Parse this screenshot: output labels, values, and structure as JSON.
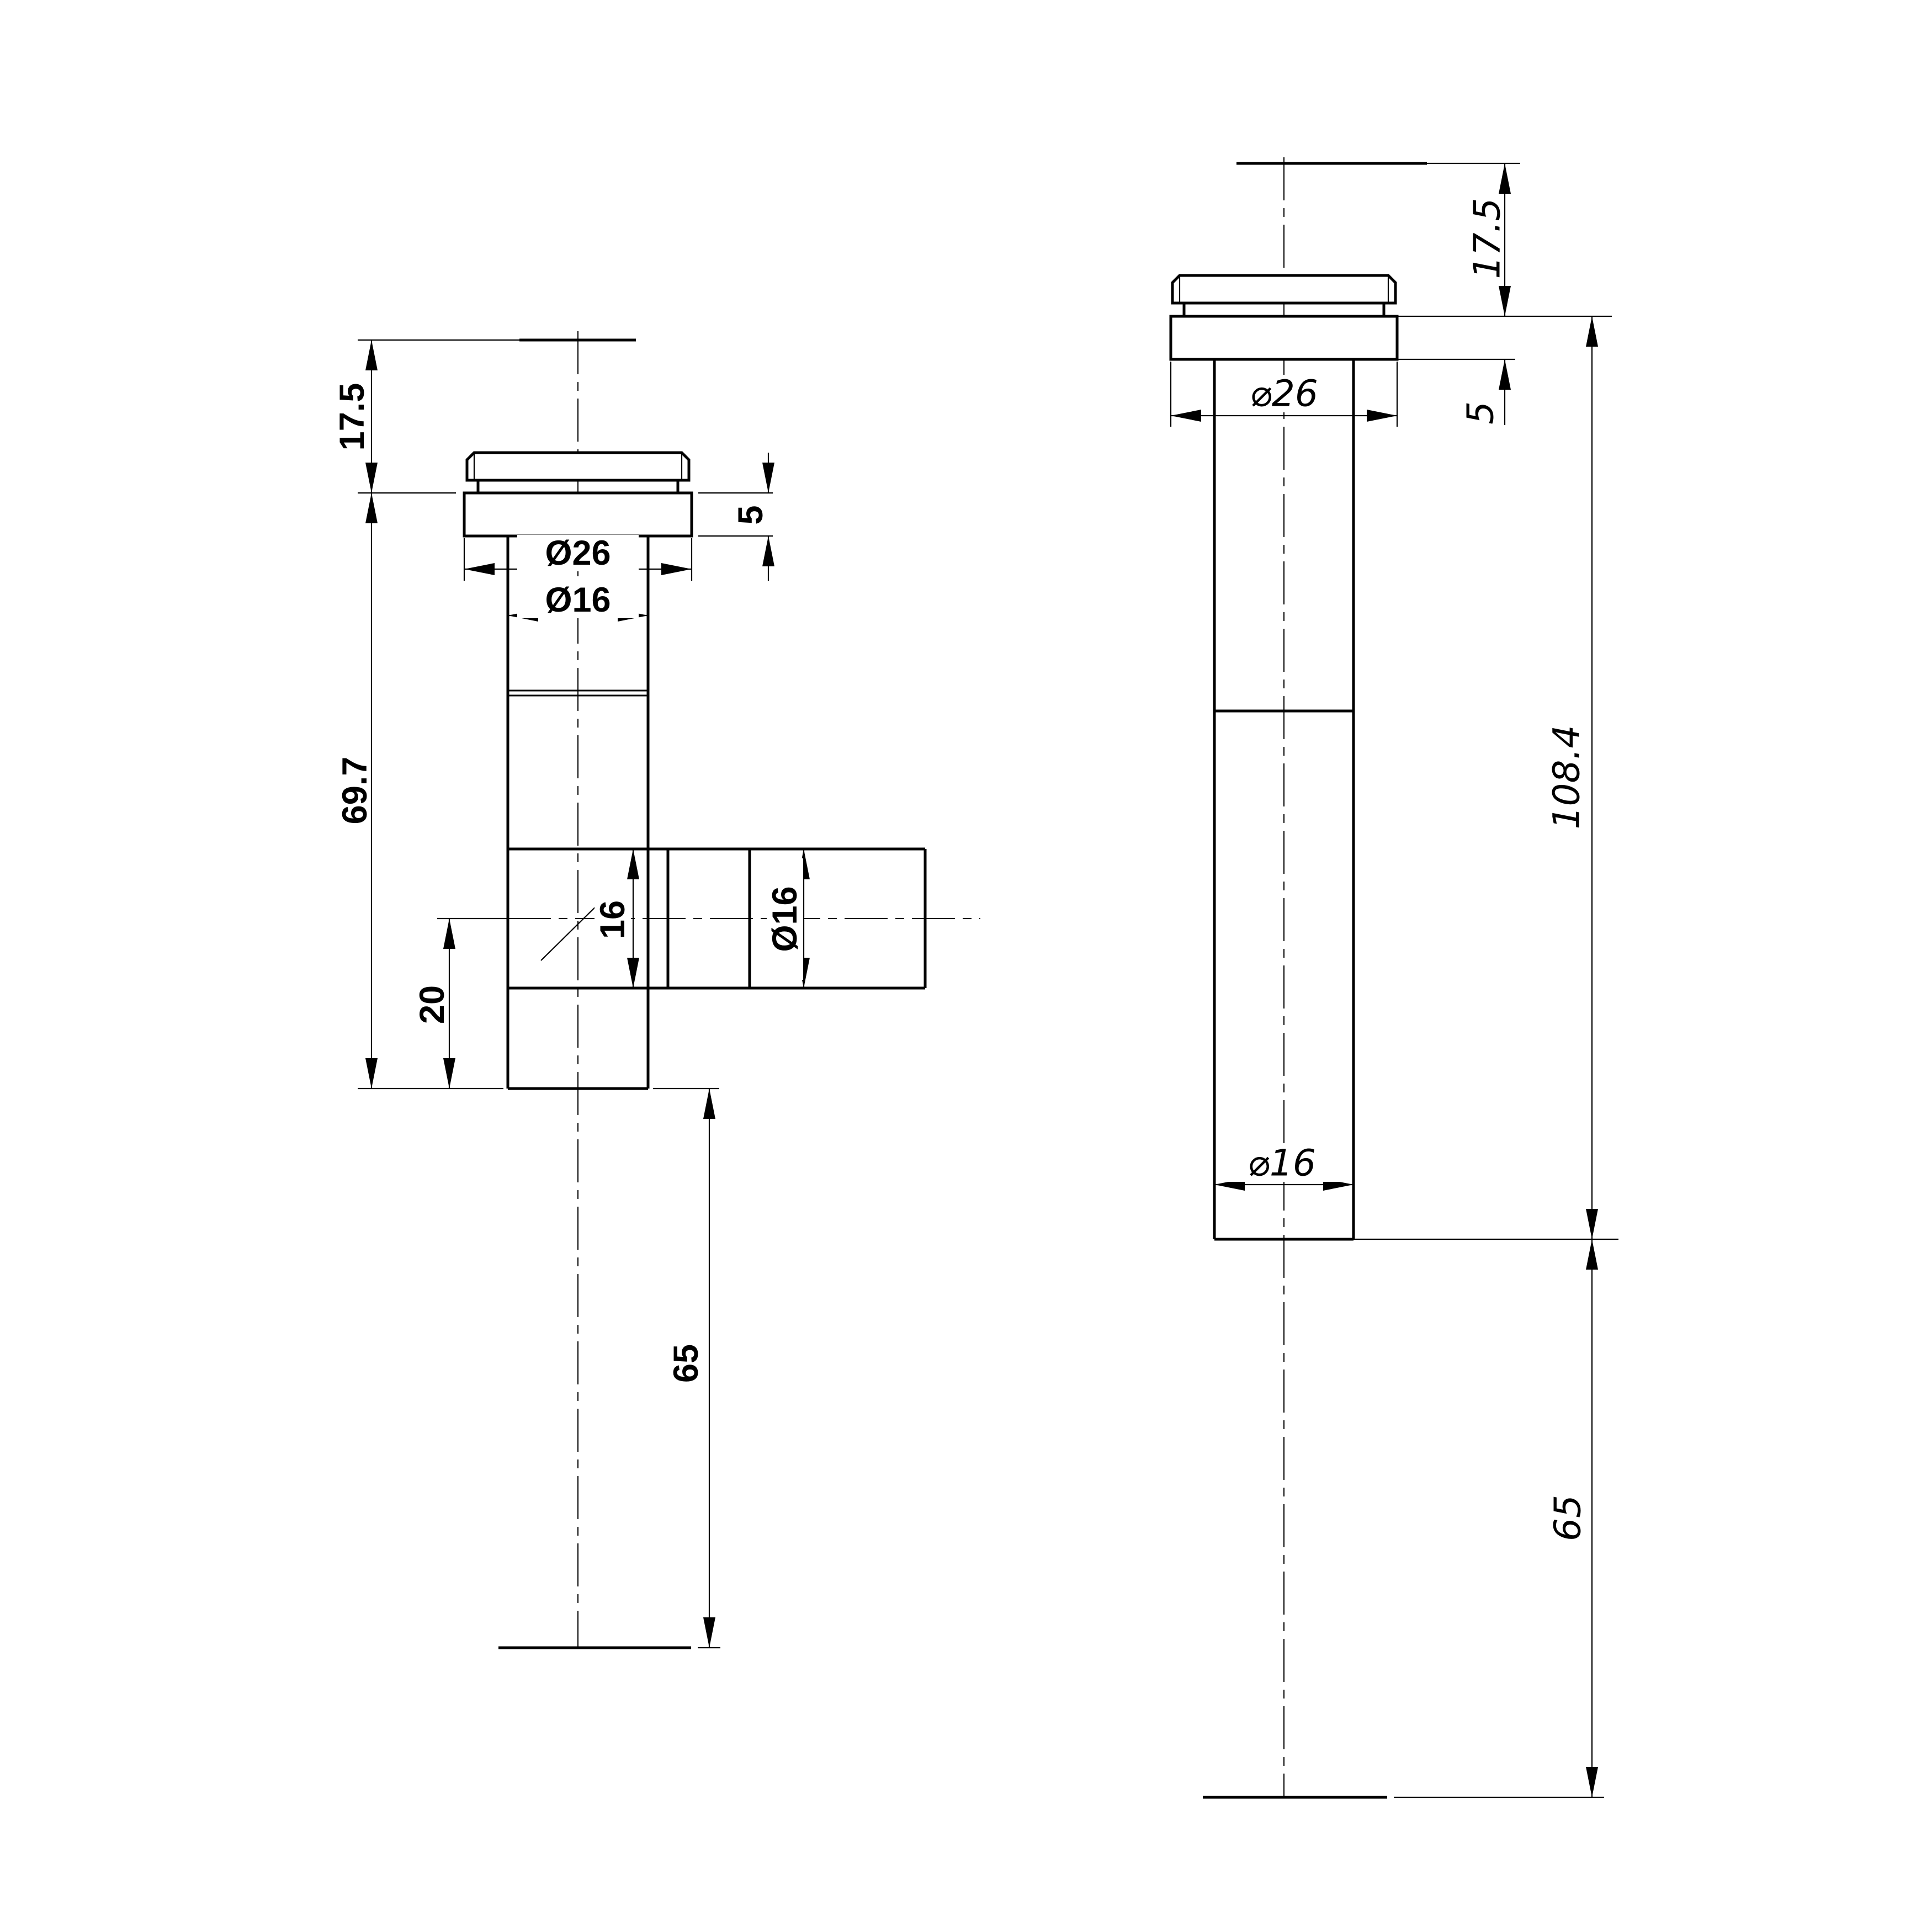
{
  "drawing": {
    "background_color": "#ffffff",
    "line_color": "#000000",
    "views": {
      "front": {
        "dims": {
          "cap_height": "17.5",
          "flange_thickness": "5",
          "flange_diameter": "Ø26",
          "pipe_diameter": "Ø16",
          "body_length": "69.7",
          "branch_bore": "16",
          "branch_diameter": "Ø16",
          "branch_center_offset": "20",
          "tail_length": "65"
        }
      },
      "side": {
        "dims": {
          "cap_height": "17.5",
          "flange_thickness": "5",
          "flange_diameter": "⌀26",
          "overall_length": "108.4",
          "pipe_diameter": "⌀16",
          "tail_length": "65"
        }
      }
    }
  }
}
